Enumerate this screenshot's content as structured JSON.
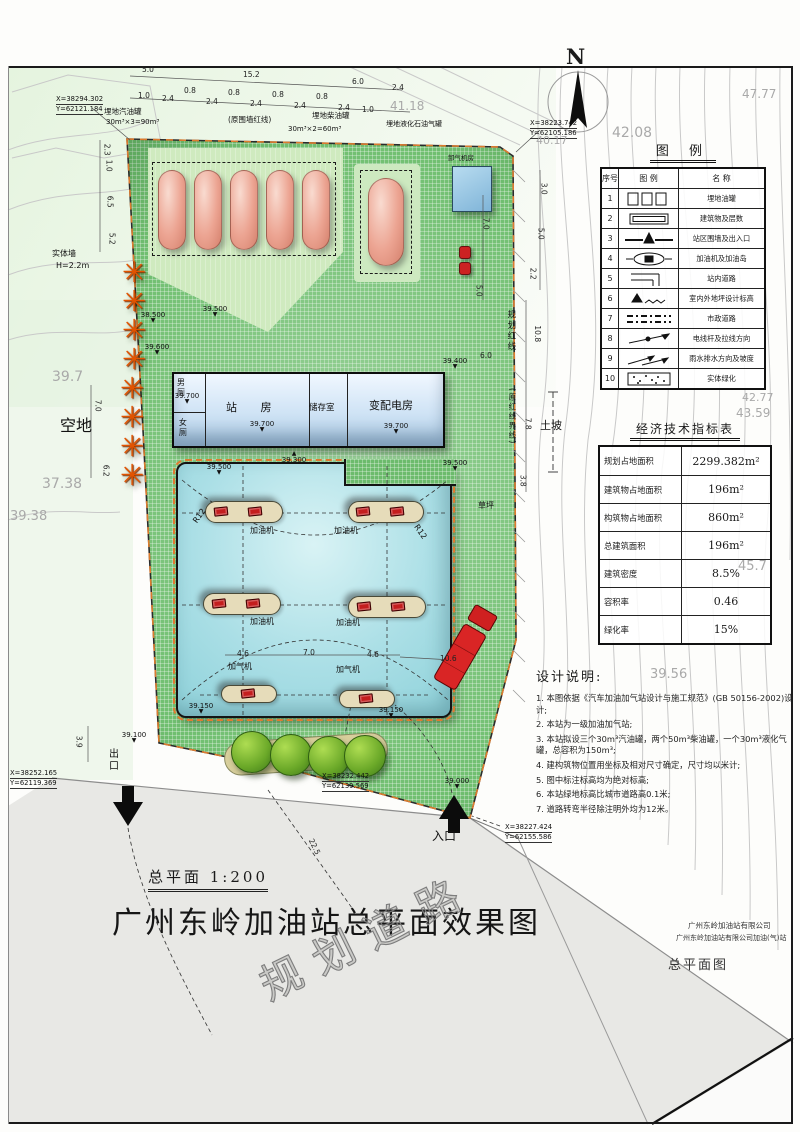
{
  "page": {
    "main_title": "广州东岭加油站总平面效果图",
    "scale_label": "总平面  1:200",
    "watermark_road": "规划道路",
    "company_line1": "广州东岭加油站有限公司",
    "company_line2": "广州东岭加油站有限公司加油(气)站",
    "drawing_name": "总平面图",
    "north_label": "N"
  },
  "legend": {
    "title": "图  例",
    "headers": [
      "序号",
      "图  例",
      "名  称"
    ],
    "rows": [
      {
        "no": "1",
        "icon": "tanks-icon",
        "name": "埋地油罐"
      },
      {
        "no": "2",
        "icon": "building-icon",
        "name": "建筑物及层数"
      },
      {
        "no": "3",
        "icon": "wall-gate-icon",
        "name": "站区围墙及出入口"
      },
      {
        "no": "4",
        "icon": "dispenser-icon",
        "name": "加油机及加油岛"
      },
      {
        "no": "5",
        "icon": "station-road-icon",
        "name": "站内道路"
      },
      {
        "no": "6",
        "icon": "elevation-icon",
        "name": "室内外地坪设计标高"
      },
      {
        "no": "7",
        "icon": "municipal-road-icon",
        "name": "市政道路"
      },
      {
        "no": "8",
        "icon": "pole-icon",
        "name": "电线杆及拉线方向"
      },
      {
        "no": "9",
        "icon": "drainage-icon",
        "name": "雨水排水方向及坡度"
      },
      {
        "no": "10",
        "icon": "greening-icon",
        "name": "实体绿化"
      }
    ]
  },
  "indicators": {
    "title": "经济技术指标表",
    "rows": [
      {
        "label": "规划占地面积",
        "value": "2299.382m²"
      },
      {
        "label": "建筑物占地面积",
        "value": "196m²"
      },
      {
        "label": "构筑物占地面积",
        "value": "860m²"
      },
      {
        "label": "总建筑面积",
        "value": "196m²"
      },
      {
        "label": "建筑密度",
        "value": "8.5%"
      },
      {
        "label": "容积率",
        "value": "0.46"
      },
      {
        "label": "绿化率",
        "value": "15%"
      }
    ]
  },
  "notes": {
    "title": "设计说明:",
    "items": [
      "1. 本图依据《汽车加油加气站设计与施工规范》(GB 50156-2002)设计;",
      "2. 本站为一级加油加气站;",
      "3. 本站拟设三个30m³汽油罐，两个50m³柴油罐，一个30m³液化气罐，总容积为150m³;",
      "4. 建构筑物位置用坐标及相对尺寸确定，尺寸均以米计;",
      "5. 图中标注标高均为绝对标高;",
      "6. 本站绿地标高比城市道路高0.1米;",
      "7. 道路转弯半径除注明外均为12米。"
    ]
  },
  "buildings": {
    "rooms": [
      "男厕",
      "女厕",
      "站  房",
      "储存室",
      "变配电房"
    ]
  },
  "site_labels": [
    {
      "x": 104,
      "y": 108,
      "t": "埋地汽油罐",
      "s": 7.5
    },
    {
      "x": 106,
      "y": 119,
      "t": "30m³×3=90m³",
      "s": 7
    },
    {
      "x": 228,
      "y": 116,
      "t": "(原围墙红线)",
      "s": 7.5
    },
    {
      "x": 312,
      "y": 112,
      "t": "埋地柴油罐",
      "s": 7.5
    },
    {
      "x": 288,
      "y": 126,
      "t": "30m³×2=60m³",
      "s": 7
    },
    {
      "x": 386,
      "y": 121,
      "t": "埋地液化石油气罐",
      "s": 7
    },
    {
      "x": 448,
      "y": 155,
      "t": "卸气机房",
      "s": 6.5
    },
    {
      "x": 60,
      "y": 418,
      "t": "空地",
      "s": 16
    },
    {
      "x": 52,
      "y": 250,
      "t": "实体墙",
      "s": 8
    },
    {
      "x": 56,
      "y": 262,
      "t": "H=2.2m",
      "s": 8
    },
    {
      "x": 506,
      "y": 310,
      "t": "规划红线",
      "s": 8.5,
      "v": 1
    },
    {
      "x": 508,
      "y": 388,
      "t": "(原红线界线)",
      "s": 7.5,
      "v": 1
    },
    {
      "x": 540,
      "y": 420,
      "t": "土坡",
      "s": 11
    },
    {
      "x": 478,
      "y": 502,
      "t": "草坪",
      "s": 8
    },
    {
      "x": 106,
      "y": 748,
      "t": "出口",
      "s": 10,
      "v": 1
    },
    {
      "x": 432,
      "y": 830,
      "t": "入口",
      "s": 12
    },
    {
      "x": 250,
      "y": 527,
      "t": "加油机",
      "s": 8
    },
    {
      "x": 334,
      "y": 527,
      "t": "加油机",
      "s": 8
    },
    {
      "x": 250,
      "y": 618,
      "t": "加油机",
      "s": 8
    },
    {
      "x": 336,
      "y": 619,
      "t": "加油机",
      "s": 8
    },
    {
      "x": 228,
      "y": 663,
      "t": "加气机",
      "s": 8
    },
    {
      "x": 336,
      "y": 666,
      "t": "加气机",
      "s": 8
    },
    {
      "x": 192,
      "y": 512,
      "t": "R12",
      "s": 8,
      "r": -55
    },
    {
      "x": 412,
      "y": 528,
      "t": "R12",
      "s": 8,
      "r": 55
    }
  ],
  "dims": [
    {
      "x": 142,
      "y": 66,
      "t": "5.0"
    },
    {
      "x": 243,
      "y": 71,
      "t": "15.2"
    },
    {
      "x": 352,
      "y": 78,
      "t": "6.0"
    },
    {
      "x": 392,
      "y": 84,
      "t": "2.4"
    },
    {
      "x": 138,
      "y": 92,
      "t": "1.0"
    },
    {
      "x": 162,
      "y": 95,
      "t": "2.4"
    },
    {
      "x": 184,
      "y": 87,
      "t": "0.8"
    },
    {
      "x": 206,
      "y": 98,
      "t": "2.4"
    },
    {
      "x": 228,
      "y": 89,
      "t": "0.8"
    },
    {
      "x": 250,
      "y": 100,
      "t": "2.4"
    },
    {
      "x": 272,
      "y": 91,
      "t": "0.8"
    },
    {
      "x": 294,
      "y": 102,
      "t": "2.4"
    },
    {
      "x": 316,
      "y": 93,
      "t": "0.8"
    },
    {
      "x": 338,
      "y": 104,
      "t": "2.4"
    },
    {
      "x": 362,
      "y": 106,
      "t": "1.0"
    },
    {
      "x": 101,
      "y": 146,
      "t": "2.3",
      "r": 90
    },
    {
      "x": 103,
      "y": 162,
      "t": "1.0",
      "r": 90
    },
    {
      "x": 104,
      "y": 198,
      "t": "6.5",
      "r": 90
    },
    {
      "x": 106,
      "y": 235,
      "t": "5.2",
      "r": 90
    },
    {
      "x": 480,
      "y": 220,
      "t": "7.0",
      "r": 90
    },
    {
      "x": 538,
      "y": 185,
      "t": "3.0",
      "r": 90
    },
    {
      "x": 535,
      "y": 230,
      "t": "5.0",
      "r": 90
    },
    {
      "x": 527,
      "y": 270,
      "t": "2.2",
      "r": 90
    },
    {
      "x": 473,
      "y": 287,
      "t": "5.0",
      "r": 90
    },
    {
      "x": 92,
      "y": 402,
      "t": "7.0",
      "r": 90
    },
    {
      "x": 100,
      "y": 467,
      "t": "6.2",
      "r": 90
    },
    {
      "x": 529,
      "y": 330,
      "t": "10.8",
      "r": 90
    },
    {
      "x": 480,
      "y": 352,
      "t": "6.0"
    },
    {
      "x": 522,
      "y": 420,
      "t": "7.8",
      "r": 90
    },
    {
      "x": 517,
      "y": 477,
      "t": "3.8",
      "r": 90
    },
    {
      "x": 237,
      "y": 650,
      "t": "4.6"
    },
    {
      "x": 303,
      "y": 649,
      "t": "7.0"
    },
    {
      "x": 367,
      "y": 651,
      "t": "4.6"
    },
    {
      "x": 440,
      "y": 655,
      "t": "10.6"
    },
    {
      "x": 73,
      "y": 738,
      "t": "3.9",
      "r": 90
    },
    {
      "x": 306,
      "y": 843,
      "t": "22.5",
      "r": 64
    }
  ],
  "elevations": [
    {
      "x": 168,
      "y": 393,
      "v": "39.700",
      "d": "d"
    },
    {
      "x": 243,
      "y": 421,
      "v": "39.700",
      "d": "d"
    },
    {
      "x": 377,
      "y": 423,
      "v": "39.700",
      "d": "d"
    },
    {
      "x": 200,
      "y": 464,
      "v": "39.500",
      "d": "d"
    },
    {
      "x": 275,
      "y": 452,
      "v": "39.300",
      "d": "u"
    },
    {
      "x": 436,
      "y": 358,
      "v": "39.400",
      "d": "d"
    },
    {
      "x": 436,
      "y": 460,
      "v": "39.500",
      "d": "d"
    },
    {
      "x": 134,
      "y": 312,
      "v": "38.500",
      "d": "d"
    },
    {
      "x": 138,
      "y": 344,
      "v": "39.600",
      "d": "d"
    },
    {
      "x": 196,
      "y": 306,
      "v": "39.500",
      "d": "d"
    },
    {
      "x": 182,
      "y": 703,
      "v": "39.150",
      "d": "d"
    },
    {
      "x": 372,
      "y": 707,
      "v": "39.150",
      "d": "d"
    },
    {
      "x": 115,
      "y": 732,
      "v": "39.100",
      "d": "d"
    },
    {
      "x": 438,
      "y": 778,
      "v": "39.000",
      "d": "d"
    }
  ],
  "coords": [
    {
      "x": 56,
      "y": 95,
      "l1": "X=38294.302",
      "l2": "Y=62121.184"
    },
    {
      "x": 530,
      "y": 119,
      "l1": "X=38223.742",
      "l2": "Y=62105.186"
    },
    {
      "x": 10,
      "y": 769,
      "l1": "X=38252.165",
      "l2": "Y=62119.369"
    },
    {
      "x": 322,
      "y": 772,
      "l1": "X=38232.442",
      "l2": "Y=62139.569"
    },
    {
      "x": 505,
      "y": 823,
      "l1": "X=38227.424",
      "l2": "Y=62155.586"
    }
  ],
  "contour_labels": [
    {
      "x": 612,
      "y": 126,
      "t": "42.08",
      "s": 14
    },
    {
      "x": 742,
      "y": 88,
      "t": "47.77",
      "s": 12
    },
    {
      "x": 390,
      "y": 100,
      "t": "41.18",
      "s": 12
    },
    {
      "x": 536,
      "y": 135,
      "t": "40.17",
      "s": 11
    },
    {
      "x": 742,
      "y": 392,
      "t": "42.77",
      "s": 11
    },
    {
      "x": 736,
      "y": 407,
      "t": "43.59",
      "s": 12
    },
    {
      "x": 738,
      "y": 560,
      "t": "45.7",
      "s": 13
    },
    {
      "x": 650,
      "y": 668,
      "t": "39.56",
      "s": 13
    },
    {
      "x": 52,
      "y": 370,
      "t": "39.7",
      "s": 14
    },
    {
      "x": 42,
      "y": 477,
      "t": "37.38",
      "s": 14
    },
    {
      "x": 10,
      "y": 510,
      "t": "39.38",
      "s": 13
    }
  ],
  "islands": [
    {
      "x": 205,
      "y": 501,
      "w": 78,
      "h": 22,
      "n": 2
    },
    {
      "x": 348,
      "y": 501,
      "w": 76,
      "h": 22,
      "n": 2
    },
    {
      "x": 203,
      "y": 593,
      "w": 78,
      "h": 22,
      "n": 2
    },
    {
      "x": 348,
      "y": 596,
      "w": 78,
      "h": 22,
      "n": 2
    },
    {
      "x": 221,
      "y": 685,
      "w": 56,
      "h": 18,
      "n": 1
    },
    {
      "x": 339,
      "y": 690,
      "w": 56,
      "h": 18,
      "n": 1
    }
  ],
  "flowers": {
    "glyph": "✳",
    "positions": [
      [
        122,
        258
      ],
      [
        122,
        287
      ],
      [
        122,
        316
      ],
      [
        122,
        345
      ],
      [
        120,
        374
      ],
      [
        120,
        403
      ],
      [
        120,
        432
      ],
      [
        120,
        461
      ]
    ]
  },
  "trees": {
    "positions": [
      [
        252,
        752
      ],
      [
        291,
        755
      ],
      [
        329,
        757
      ],
      [
        365,
        756
      ]
    ],
    "radius": 21
  },
  "gas_tanks": {
    "xs": [
      158,
      194,
      230,
      266,
      302
    ],
    "y": 170,
    "w": 28,
    "h": 80
  },
  "bottles": [
    [
      459,
      246
    ],
    [
      459,
      262
    ]
  ]
}
